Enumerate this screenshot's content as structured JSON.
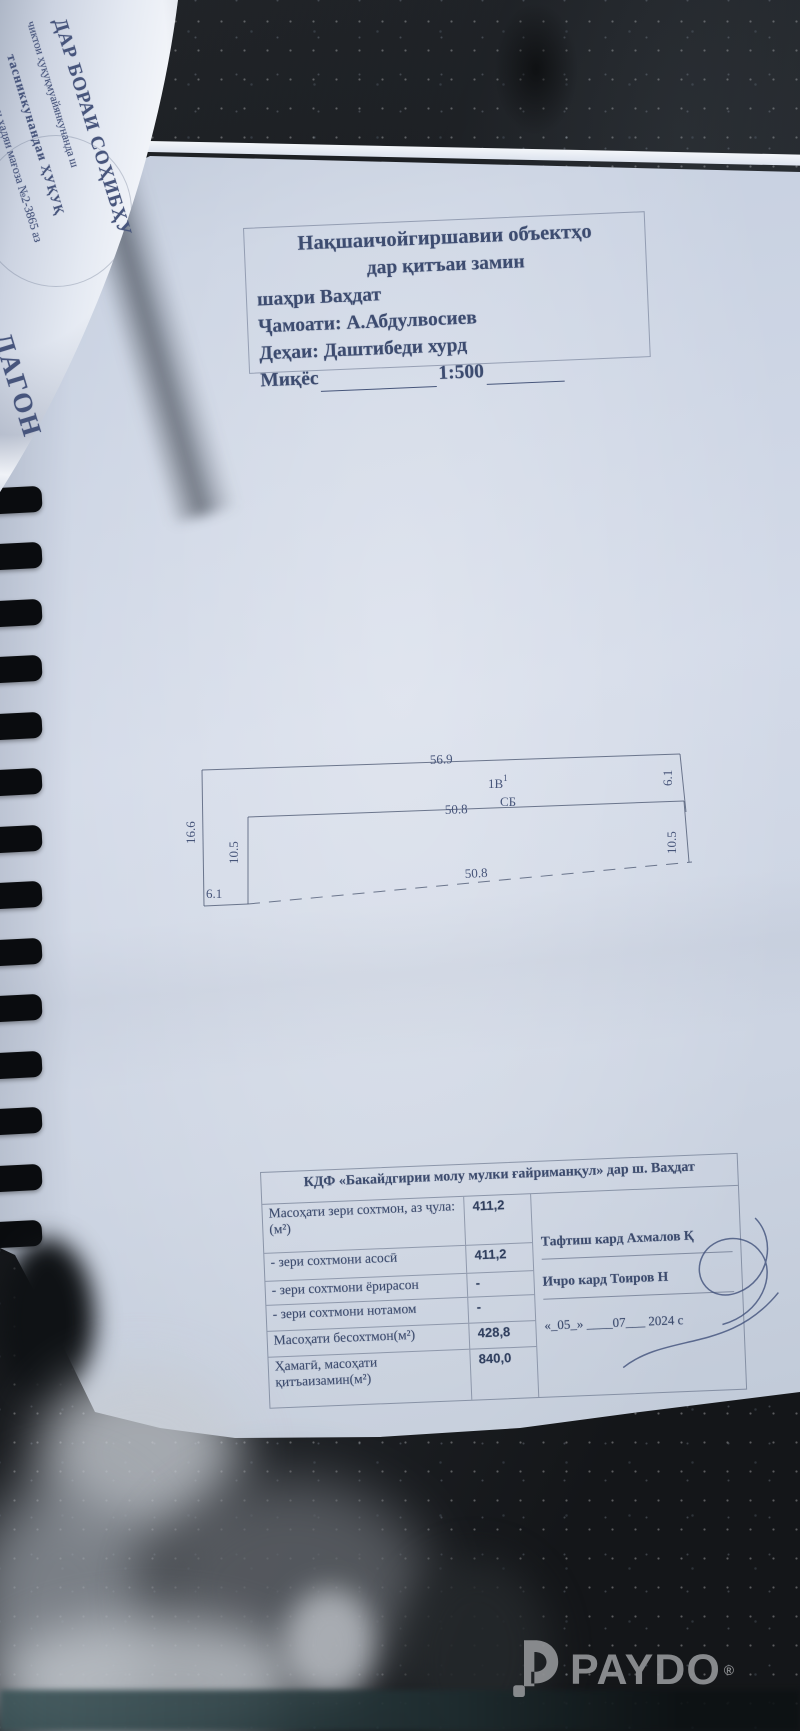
{
  "flipped_page": {
    "lines": [
      "ДАР БОРАИ СОҲИБҲУ",
      "чиктои ҳуқуқмуайянкунанда ш",
      "тасниккунандаи ҲУҚУҚ",
      "и ҳадяи мағоза №2-3865 аз",
      "ЛАГОН",
      "да"
    ]
  },
  "title_block": {
    "line1": "Нақшаичойгиршавии объектҳо",
    "line2": "дар қитъаи замин",
    "line3": "шаҳри Ваҳдат",
    "line4": "Ҷамоати: А.Абдулвосиев",
    "line5": "Деҳаи: Даштибеди хурд",
    "scale_label": "Миқёс",
    "scale_value": "1:500"
  },
  "site_plan": {
    "dim_top_outer": "56.9",
    "building_label": "1В",
    "building_label_sup": "1",
    "building_type": "СБ",
    "dim_top_inner": "50.8",
    "dim_left_outer": "16.6",
    "dim_left_inner": "10.5",
    "dim_right_outer": "6.1",
    "dim_right_inner": "10.5",
    "dim_bottom_left": "6.1",
    "dim_bottom_inner": "50.8"
  },
  "info_table": {
    "header": "КДФ «Бакайдгирии молу мулки ғайриманқул» дар ш. Ваҳдат",
    "rows": [
      {
        "label": "Масоҳати зери сохтмон, аз ҷула:(м²)",
        "value": "411,2"
      },
      {
        "label": "- зери сохтмони асосӣ",
        "value": "411,2"
      },
      {
        "label": "- зери сохтмони ёрирасон",
        "value": "-"
      },
      {
        "label": "- зери сохтмони нотамом",
        "value": "-"
      },
      {
        "label": "Масоҳати бесохтмон(м²)",
        "value": "428,8"
      },
      {
        "label": "Ҳамагӣ, масоҳати қитъаизамин(м²)",
        "value": "840,0"
      }
    ],
    "checked_by": "Тафтиш кард  Ахмалов Қ",
    "executed_by": "Ичро кард  Тоиров Н",
    "date_line": "«_05_» ____07___ 2024 с"
  },
  "watermark": {
    "brand": "PAYDO",
    "registered": "®"
  }
}
